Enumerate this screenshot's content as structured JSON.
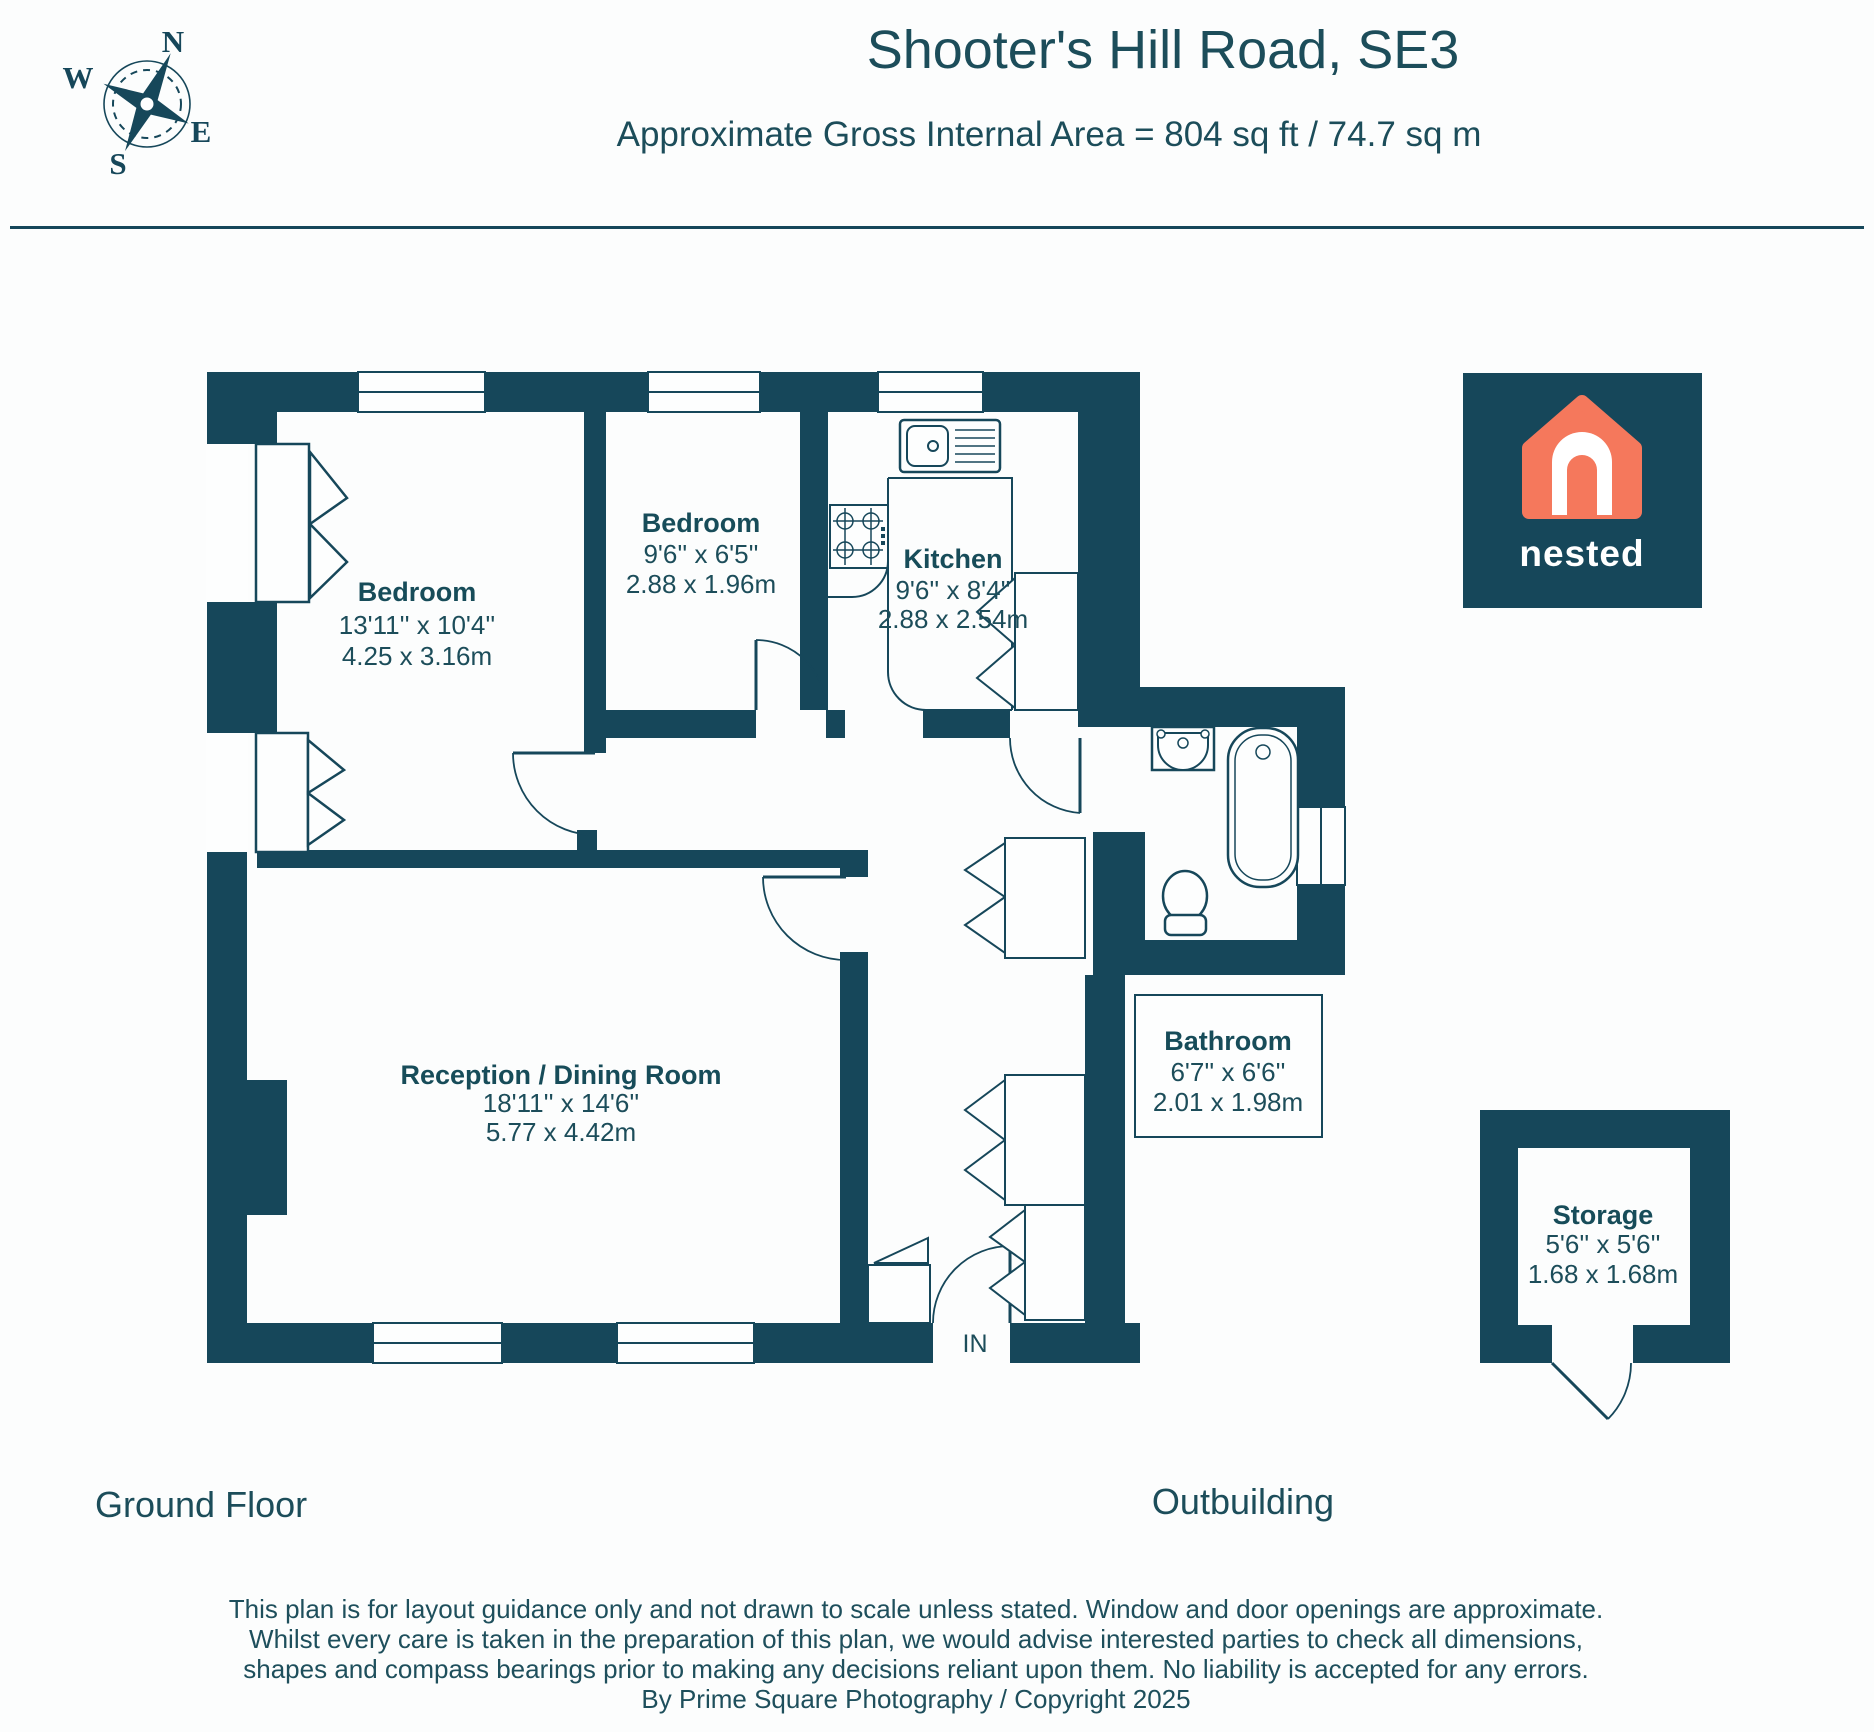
{
  "header": {
    "title": "Shooter's Hill Road, SE3",
    "subtitle": "Approximate Gross Internal Area = 804 sq ft / 74.7 sq m"
  },
  "compass": {
    "n": "N",
    "e": "E",
    "s": "S",
    "w": "W"
  },
  "logo": {
    "brand": "nested"
  },
  "rooms": {
    "bedroom1": {
      "name": "Bedroom",
      "imperial": "13'11'' x 10'4''",
      "metric": "4.25 x 3.16m"
    },
    "bedroom2": {
      "name": "Bedroom",
      "imperial": "9'6'' x 6'5''",
      "metric": "2.88 x 1.96m"
    },
    "kitchen": {
      "name": "Kitchen",
      "imperial": "9'6'' x 8'4''",
      "metric": "2.88 x 2.54m"
    },
    "reception": {
      "name": "Reception / Dining Room",
      "imperial": "18'11'' x 14'6''",
      "metric": "5.77 x 4.42m"
    },
    "bathroom": {
      "name": "Bathroom",
      "imperial": "6'7'' x 6'6''",
      "metric": "2.01 x 1.98m"
    },
    "storage": {
      "name": "Storage",
      "imperial": "5'6'' x 5'6''",
      "metric": "1.68 x 1.68m"
    }
  },
  "floor_labels": {
    "ground": "Ground Floor",
    "outbuilding": "Outbuilding"
  },
  "entrance_label": "IN",
  "disclaimer": {
    "line1": "This plan is for layout guidance only and not drawn to scale unless stated. Window and door openings are approximate.",
    "line2": "Whilst every care is taken in the preparation of this plan, we would advise interested parties to check all dimensions,",
    "line3": "shapes and compass bearings prior to making any decisions reliant upon them. No liability is accepted for any errors.",
    "line4": "By Prime Square Photography / Copyright 2025"
  },
  "colors": {
    "wall": "#16475A",
    "accent": "#F5785C",
    "text": "#1C4D5A",
    "white": "#FDFEFE"
  }
}
